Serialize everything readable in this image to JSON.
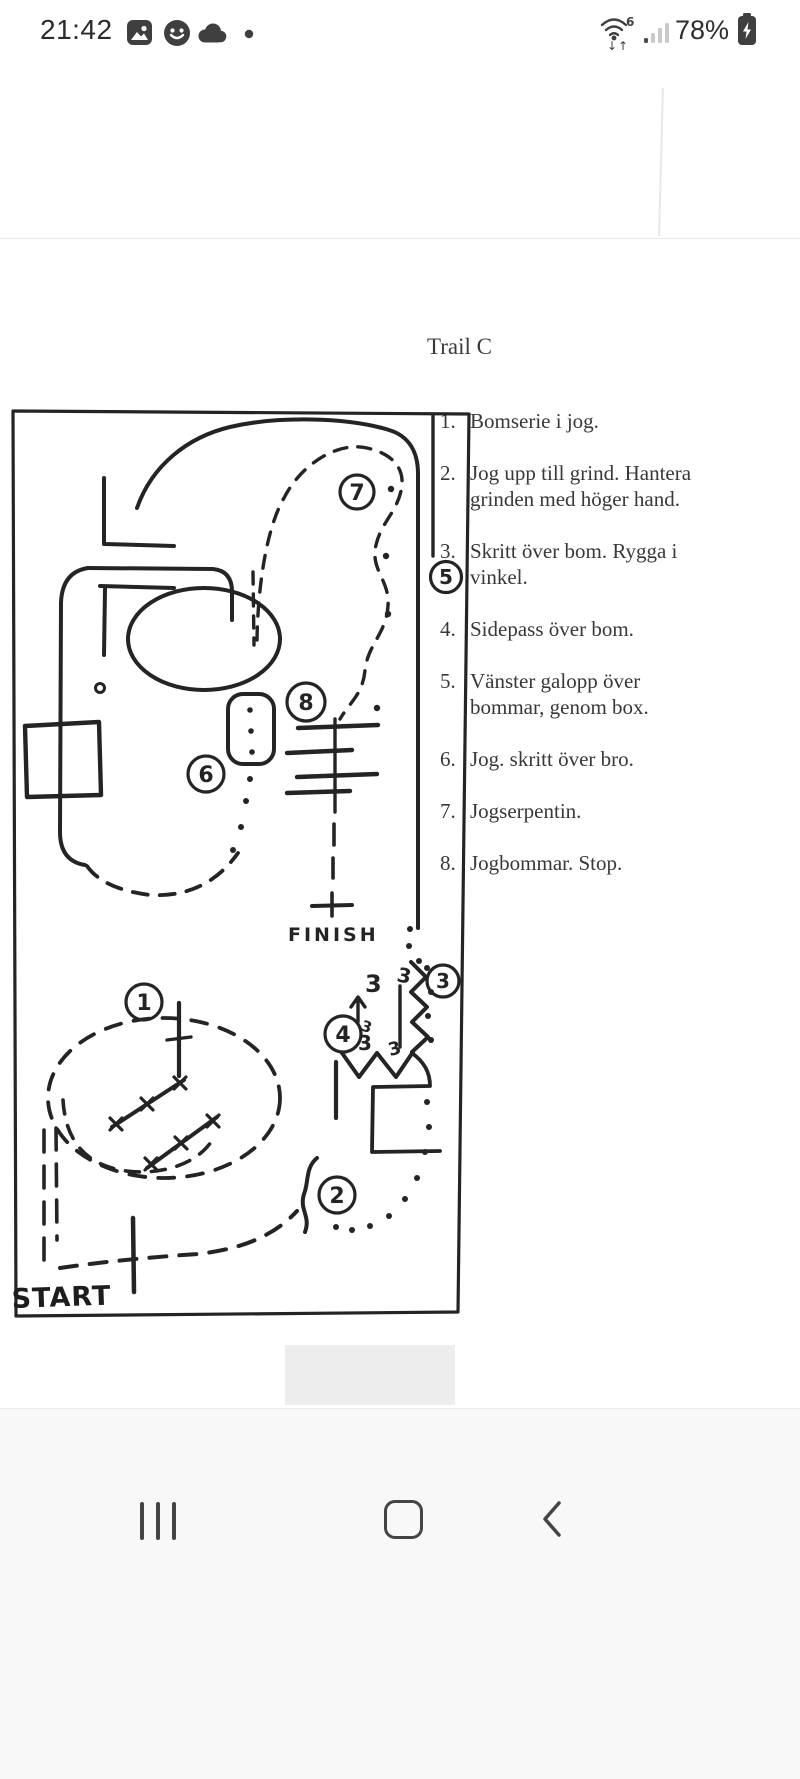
{
  "status_bar": {
    "time": "21:42",
    "battery_percent": "78%",
    "wifi_generation": "6",
    "icons": [
      "gallery-icon",
      "smiley-icon",
      "cloud-icon",
      "notification-dot",
      "wifi-icon",
      "signal-icon",
      "battery-charging-icon"
    ]
  },
  "page": {
    "title": "Trail C",
    "instructions": [
      {
        "num": "1.",
        "text": "Bomserie i jog."
      },
      {
        "num": "2.",
        "text": "Jog upp till grind. Hantera\ngrinden med höger hand."
      },
      {
        "num": "3.",
        "text": "Skritt över bom. Rygga i\nvinkel."
      },
      {
        "num": "4.",
        "text": "Sidepass över bom."
      },
      {
        "num": "5.",
        "text": "Vänster galopp över\nbommar, genom box."
      },
      {
        "num": "6.",
        "text": "Jog. skritt över bro."
      },
      {
        "num": "7.",
        "text": "Jogserpentin."
      },
      {
        "num": "8.",
        "text": "Jogbommar. Stop."
      }
    ],
    "map": {
      "start": "START",
      "finish": "FINISH",
      "markers": [
        "1",
        "2",
        "3",
        "4",
        "5",
        "6",
        "7",
        "8"
      ],
      "pole_labels": [
        "3",
        "3",
        "3",
        "3",
        "3"
      ]
    }
  },
  "nav": {
    "icons": [
      "recents-icon",
      "home-icon",
      "back-icon"
    ]
  }
}
